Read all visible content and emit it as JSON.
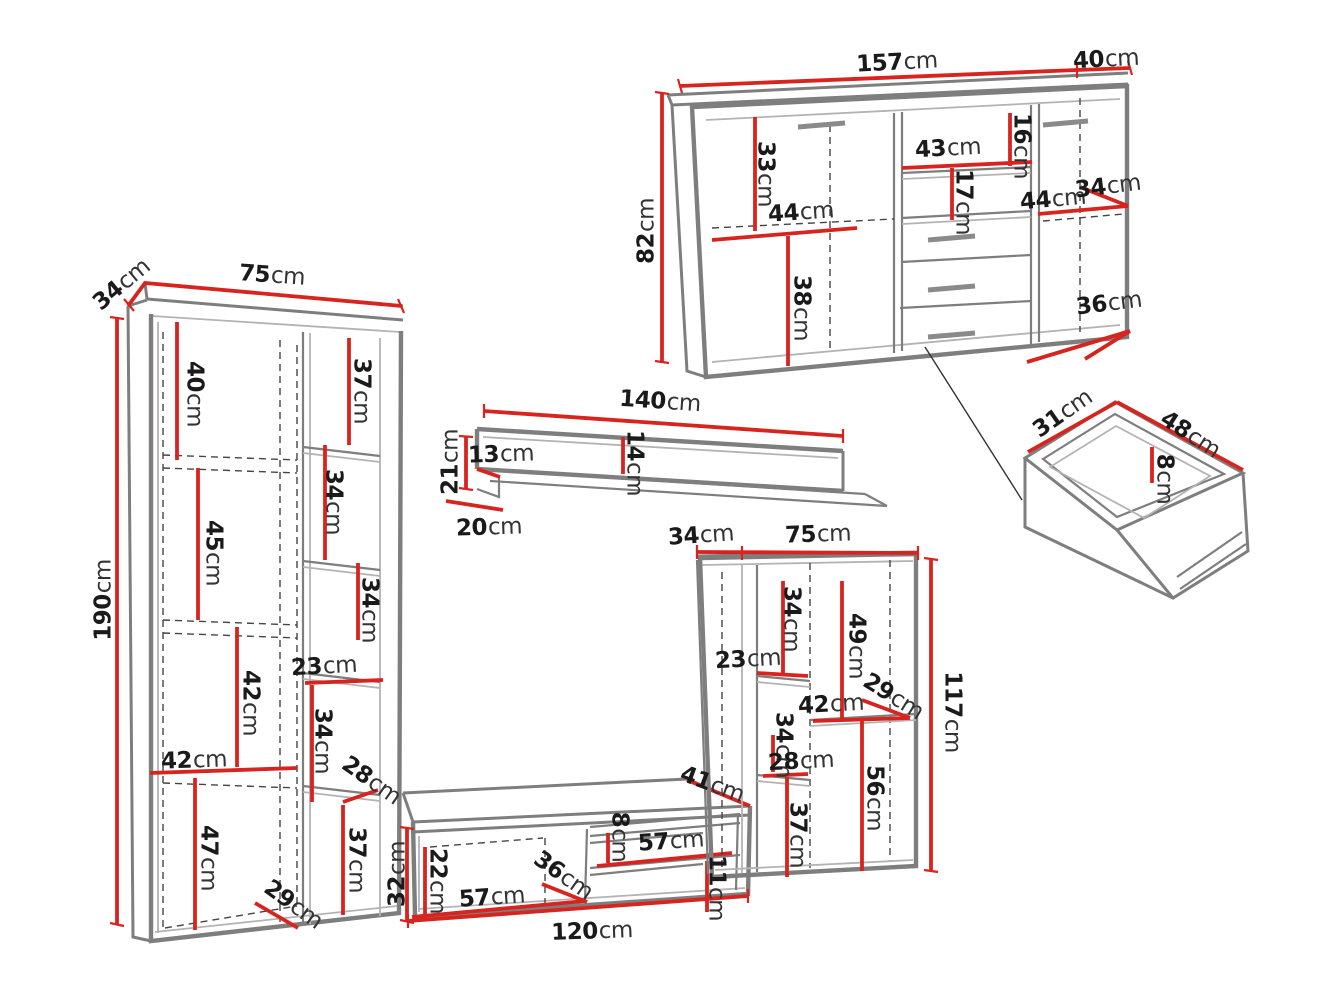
{
  "diagram": {
    "unit": "cm",
    "description": "furniture-wall-unit-dimension-diagram",
    "pieces": [
      {
        "id": "sideboard",
        "width": "157",
        "depth": "40",
        "height": "82"
      },
      {
        "id": "bookcase",
        "width": "75",
        "depth": "34",
        "height": "190"
      },
      {
        "id": "wall-shelf",
        "width": "140",
        "height": "21",
        "depth": "20"
      },
      {
        "id": "tv-stand",
        "width": "120",
        "height": "32",
        "depth": "41"
      },
      {
        "id": "tall-cabinet",
        "width": "75",
        "depth": "34",
        "height": "117"
      },
      {
        "id": "drawer",
        "width": "48",
        "depth": "31",
        "height": "8"
      }
    ]
  },
  "colors": {
    "dimension_red": "#d7241f",
    "outline_gray": "#7e7e7e",
    "light_gray": "#b3b3b3",
    "dash_gray": "#454545",
    "text": "#1a1a1a",
    "background": "#ffffff"
  },
  "labels": [
    {
      "piece": "sideboard",
      "num": "157",
      "unit": "cm",
      "x": 897,
      "y": 63,
      "r": -3
    },
    {
      "piece": "sideboard",
      "num": "40",
      "unit": "cm",
      "x": 1106,
      "y": 60,
      "r": -3
    },
    {
      "piece": "sideboard",
      "num": "82",
      "unit": "cm",
      "x": 647,
      "y": 231,
      "r": -90
    },
    {
      "piece": "sideboard",
      "num": "33",
      "unit": "cm",
      "x": 765,
      "y": 174,
      "r": 90
    },
    {
      "piece": "sideboard",
      "num": "44",
      "unit": "cm",
      "x": 801,
      "y": 213,
      "r": -4
    },
    {
      "piece": "sideboard",
      "num": "38",
      "unit": "cm",
      "x": 801,
      "y": 308,
      "r": 90
    },
    {
      "piece": "sideboard",
      "num": "43",
      "unit": "cm",
      "x": 948,
      "y": 149,
      "r": -3
    },
    {
      "piece": "sideboard",
      "num": "16",
      "unit": "cm",
      "x": 1021,
      "y": 146,
      "r": 90
    },
    {
      "piece": "sideboard",
      "num": "17",
      "unit": "cm",
      "x": 963,
      "y": 202,
      "r": 90
    },
    {
      "piece": "sideboard",
      "num": "44",
      "unit": "cm",
      "x": 1053,
      "y": 200,
      "r": -5
    },
    {
      "piece": "sideboard",
      "num": "34",
      "unit": "cm",
      "x": 1108,
      "y": 187,
      "r": -7
    },
    {
      "piece": "sideboard",
      "num": "36",
      "unit": "cm",
      "x": 1109,
      "y": 304,
      "r": -7
    },
    {
      "piece": "wall-shelf",
      "num": "140",
      "unit": "cm",
      "x": 660,
      "y": 402,
      "r": 4
    },
    {
      "piece": "wall-shelf",
      "num": "21",
      "unit": "cm",
      "x": 451,
      "y": 462,
      "r": -90
    },
    {
      "piece": "wall-shelf",
      "num": "13",
      "unit": "cm",
      "x": 501,
      "y": 455,
      "r": -2
    },
    {
      "piece": "wall-shelf",
      "num": "14",
      "unit": "cm",
      "x": 634,
      "y": 463,
      "r": 90
    },
    {
      "piece": "wall-shelf",
      "num": "20",
      "unit": "cm",
      "x": 489,
      "y": 528,
      "r": -2
    },
    {
      "piece": "bookcase",
      "num": "34",
      "unit": "cm",
      "x": 122,
      "y": 285,
      "r": -40
    },
    {
      "piece": "bookcase",
      "num": "75",
      "unit": "cm",
      "x": 272,
      "y": 276,
      "r": 4
    },
    {
      "piece": "bookcase",
      "num": "190",
      "unit": "cm",
      "x": 104,
      "y": 600,
      "r": -90
    },
    {
      "piece": "bookcase",
      "num": "40",
      "unit": "cm",
      "x": 194,
      "y": 394,
      "r": 90
    },
    {
      "piece": "bookcase",
      "num": "45",
      "unit": "cm",
      "x": 213,
      "y": 553,
      "r": 90
    },
    {
      "piece": "bookcase",
      "num": "37",
      "unit": "cm",
      "x": 361,
      "y": 391,
      "r": 90
    },
    {
      "piece": "bookcase",
      "num": "34",
      "unit": "cm",
      "x": 333,
      "y": 502,
      "r": 90
    },
    {
      "piece": "bookcase",
      "num": "34",
      "unit": "cm",
      "x": 369,
      "y": 610,
      "r": 90
    },
    {
      "piece": "bookcase",
      "num": "23",
      "unit": "cm",
      "x": 324,
      "y": 667,
      "r": -3
    },
    {
      "piece": "bookcase",
      "num": "42",
      "unit": "cm",
      "x": 250,
      "y": 703,
      "r": 90
    },
    {
      "piece": "bookcase",
      "num": "42",
      "unit": "cm",
      "x": 194,
      "y": 761,
      "r": -2
    },
    {
      "piece": "bookcase",
      "num": "34",
      "unit": "cm",
      "x": 322,
      "y": 741,
      "r": 90
    },
    {
      "piece": "bookcase",
      "num": "28",
      "unit": "cm",
      "x": 371,
      "y": 781,
      "r": 35
    },
    {
      "piece": "bookcase",
      "num": "47",
      "unit": "cm",
      "x": 208,
      "y": 858,
      "r": 90
    },
    {
      "piece": "bookcase",
      "num": "37",
      "unit": "cm",
      "x": 356,
      "y": 860,
      "r": 90
    },
    {
      "piece": "bookcase",
      "num": "29",
      "unit": "cm",
      "x": 293,
      "y": 905,
      "r": 36
    },
    {
      "piece": "tv-stand",
      "num": "41",
      "unit": "cm",
      "x": 712,
      "y": 785,
      "r": 20
    },
    {
      "piece": "tv-stand",
      "num": "32",
      "unit": "cm",
      "x": 398,
      "y": 874,
      "r": -90
    },
    {
      "piece": "tv-stand",
      "num": "22",
      "unit": "cm",
      "x": 437,
      "y": 881,
      "r": 90
    },
    {
      "piece": "tv-stand",
      "num": "57",
      "unit": "cm",
      "x": 492,
      "y": 898,
      "r": -4
    },
    {
      "piece": "tv-stand",
      "num": "36",
      "unit": "cm",
      "x": 563,
      "y": 876,
      "r": 35
    },
    {
      "piece": "tv-stand",
      "num": "8",
      "unit": "cm",
      "x": 619,
      "y": 837,
      "r": 90
    },
    {
      "piece": "tv-stand",
      "num": "57",
      "unit": "cm",
      "x": 671,
      "y": 842,
      "r": -4
    },
    {
      "piece": "tv-stand",
      "num": "11",
      "unit": "cm",
      "x": 716,
      "y": 888,
      "r": 90
    },
    {
      "piece": "tv-stand",
      "num": "120",
      "unit": "cm",
      "x": 592,
      "y": 932,
      "r": -2
    },
    {
      "piece": "tall-cabinet",
      "num": "34",
      "unit": "cm",
      "x": 701,
      "y": 536,
      "r": -4
    },
    {
      "piece": "tall-cabinet",
      "num": "75",
      "unit": "cm",
      "x": 818,
      "y": 535,
      "r": -2
    },
    {
      "piece": "tall-cabinet",
      "num": "117",
      "unit": "cm",
      "x": 952,
      "y": 712,
      "r": 90
    },
    {
      "piece": "tall-cabinet",
      "num": "34",
      "unit": "cm",
      "x": 791,
      "y": 619,
      "r": 90
    },
    {
      "piece": "tall-cabinet",
      "num": "49",
      "unit": "cm",
      "x": 856,
      "y": 646,
      "r": 90
    },
    {
      "piece": "tall-cabinet",
      "num": "23",
      "unit": "cm",
      "x": 748,
      "y": 660,
      "r": -3
    },
    {
      "piece": "tall-cabinet",
      "num": "42",
      "unit": "cm",
      "x": 831,
      "y": 705,
      "r": -3
    },
    {
      "piece": "tall-cabinet",
      "num": "29",
      "unit": "cm",
      "x": 893,
      "y": 697,
      "r": 32
    },
    {
      "piece": "tall-cabinet",
      "num": "34",
      "unit": "cm",
      "x": 783,
      "y": 745,
      "r": 90
    },
    {
      "piece": "tall-cabinet",
      "num": "28",
      "unit": "cm",
      "x": 801,
      "y": 762,
      "r": -3
    },
    {
      "piece": "tall-cabinet",
      "num": "37",
      "unit": "cm",
      "x": 797,
      "y": 835,
      "r": 90
    },
    {
      "piece": "tall-cabinet",
      "num": "56",
      "unit": "cm",
      "x": 874,
      "y": 798,
      "r": 90
    },
    {
      "piece": "drawer",
      "num": "31",
      "unit": "cm",
      "x": 1063,
      "y": 414,
      "r": -35
    },
    {
      "piece": "drawer",
      "num": "48",
      "unit": "cm",
      "x": 1190,
      "y": 435,
      "r": 33
    },
    {
      "piece": "drawer",
      "num": "8",
      "unit": "cm",
      "x": 1164,
      "y": 479,
      "r": 90
    }
  ]
}
